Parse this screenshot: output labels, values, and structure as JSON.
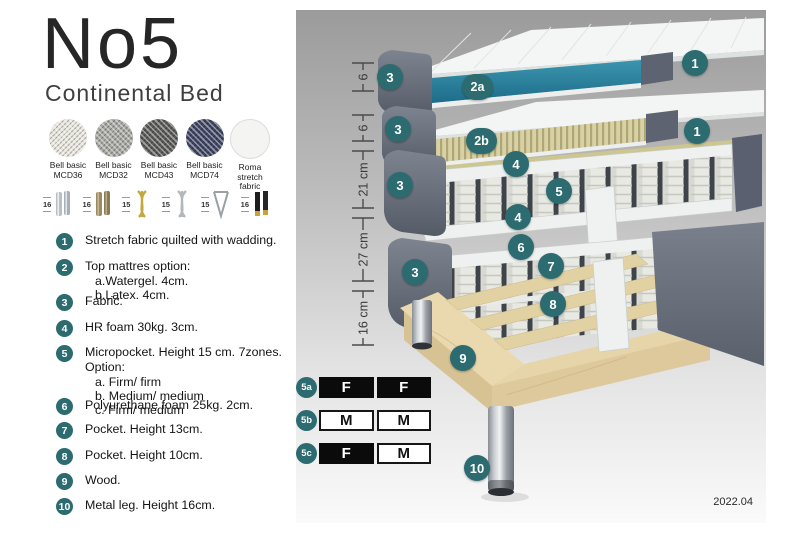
{
  "header": {
    "title": "No5",
    "subtitle": "Continental Bed"
  },
  "fabric_swatches": [
    {
      "line1": "Bell basic",
      "line2": "MCD36",
      "color": "#e9e6de"
    },
    {
      "line1": "Bell basic",
      "line2": "MCD32",
      "color": "#a7a7a3"
    },
    {
      "line1": "Bell basic",
      "line2": "MCD43",
      "color": "#5a5a58"
    },
    {
      "line1": "Bell basic",
      "line2": "MCD74",
      "color": "#3f4563"
    },
    {
      "line1": "Roma",
      "line2": "stretch fabric",
      "color": "#f4f4f2"
    }
  ],
  "leg_options": [
    {
      "size": "16",
      "icon": "chrome-cylinder-legs"
    },
    {
      "size": "16",
      "icon": "bronze-cylinder-legs"
    },
    {
      "size": "15",
      "icon": "gold-twisted-legs"
    },
    {
      "size": "15",
      "icon": "silver-twisted-legs"
    },
    {
      "size": "15",
      "icon": "hairpin-legs"
    },
    {
      "size": "16",
      "icon": "black-gold-legs"
    }
  ],
  "features": [
    {
      "num": "1",
      "text": "Stretch fabric quilted with wadding."
    },
    {
      "num": "2",
      "text": "Top mattres option:",
      "sub": [
        "a.Watergel. 4cm.",
        "b.Latex. 4cm."
      ]
    },
    {
      "num": "3",
      "text": "Fabric."
    },
    {
      "num": "4",
      "text": "HR foam 30kg. 3cm."
    },
    {
      "num": "5",
      "text": "Micropocket. Height 15 cm. 7zones. Option:",
      "sub": [
        "a. Firm/ firm",
        "b. Medium/ medium",
        "c. Firm/ medium"
      ]
    },
    {
      "num": "6",
      "text": "Polyurethane foam 25kg. 2cm."
    },
    {
      "num": "7",
      "text": "Pocket. Height 13cm."
    },
    {
      "num": "8",
      "text": "Pocket. Height 10cm."
    },
    {
      "num": "9",
      "text": "Wood."
    },
    {
      "num": "10",
      "text": "Metal leg. Height 16cm."
    }
  ],
  "diagram": {
    "dimensions": [
      "6",
      "6",
      "21 cm",
      "27 cm",
      "16 cm"
    ],
    "callouts": [
      "1",
      "2a",
      "3",
      "1",
      "2b",
      "3",
      "4",
      "5",
      "4",
      "3",
      "6",
      "7",
      "8",
      "3",
      "9",
      "10"
    ],
    "date": "2022.04",
    "colors": {
      "callout_bg": "#2c6b6f",
      "teal_core": "#2a7f9b",
      "latex_core": "#d9d2a4",
      "fabric_gray": "#666c77",
      "wood": "#e6d5aa",
      "panel_top": "#9b9b9b"
    }
  },
  "firmness": {
    "rows": [
      {
        "id": "5a",
        "cells": [
          {
            "label": "F",
            "filled": true
          },
          {
            "label": "F",
            "filled": true
          }
        ]
      },
      {
        "id": "5b",
        "cells": [
          {
            "label": "M",
            "filled": false
          },
          {
            "label": "M",
            "filled": false
          }
        ]
      },
      {
        "id": "5c",
        "cells": [
          {
            "label": "F",
            "filled": true
          },
          {
            "label": "M",
            "filled": false
          }
        ]
      }
    ]
  }
}
